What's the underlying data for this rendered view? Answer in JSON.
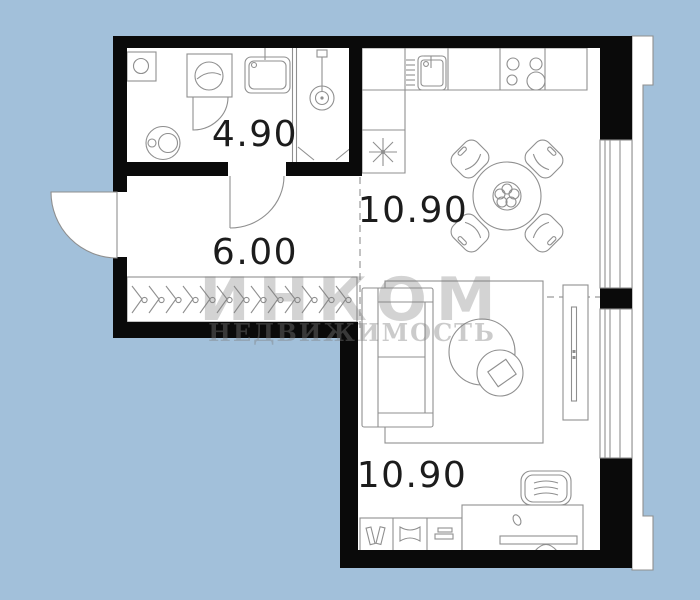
{
  "floorplan": {
    "colors": {
      "background": "#a2c0da",
      "walls": "#0a0a0a",
      "interior": "#ffffff",
      "furniture_lines": "#8f8f8f",
      "label_text": "#1c1c1c",
      "watermark": "#7d7d7d"
    },
    "rooms": [
      {
        "name": "bathroom",
        "area": "4.90"
      },
      {
        "name": "hallway",
        "area": "6.00"
      },
      {
        "name": "kitchen-dining",
        "area": "10.90"
      },
      {
        "name": "living-workspace",
        "area": "10.90"
      }
    ],
    "watermark": {
      "brand": "ИНКОМ",
      "subtitle": "НЕДВИЖИМОСТЬ"
    }
  }
}
